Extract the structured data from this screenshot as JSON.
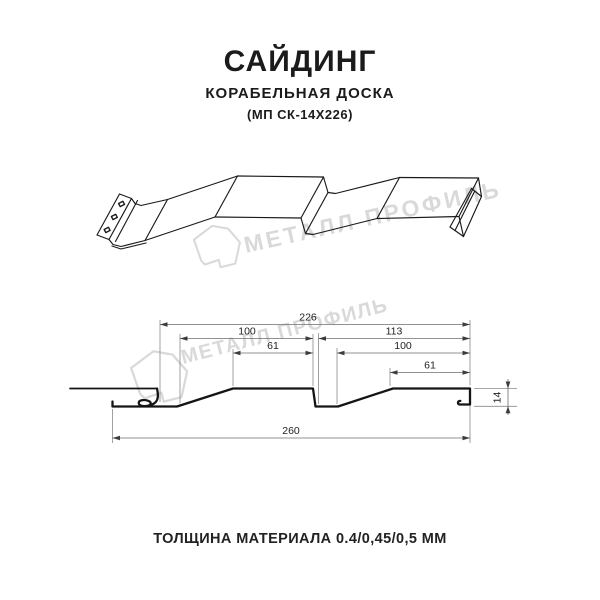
{
  "header": {
    "title": "САЙДИНГ",
    "subtitle": "КОРАБЕЛЬНАЯ ДОСКА",
    "product_code": "(МП СК-14Х226)"
  },
  "watermark": {
    "brand": "МЕТАЛЛ ПРОФИЛЬ",
    "color": "#d9d9d9"
  },
  "drawing": {
    "type": "technical-profile-diagram",
    "views": [
      "perspective-3d-profile",
      "cross-section-with-dimensions"
    ],
    "line_color": "#1a1a1a",
    "dim_line_color": "#8a8a8a",
    "dimensions_mm": {
      "cover_width": "226",
      "board1_width": "100",
      "board1_flat": "61",
      "right_span": "113",
      "board2_width": "100",
      "board2_flat": "61",
      "overall_width": "260",
      "profile_height": "14"
    }
  },
  "footer": {
    "thickness_note": "ТОЛЩИНА МАТЕРИАЛА 0.4/0,45/0,5 ММ"
  }
}
